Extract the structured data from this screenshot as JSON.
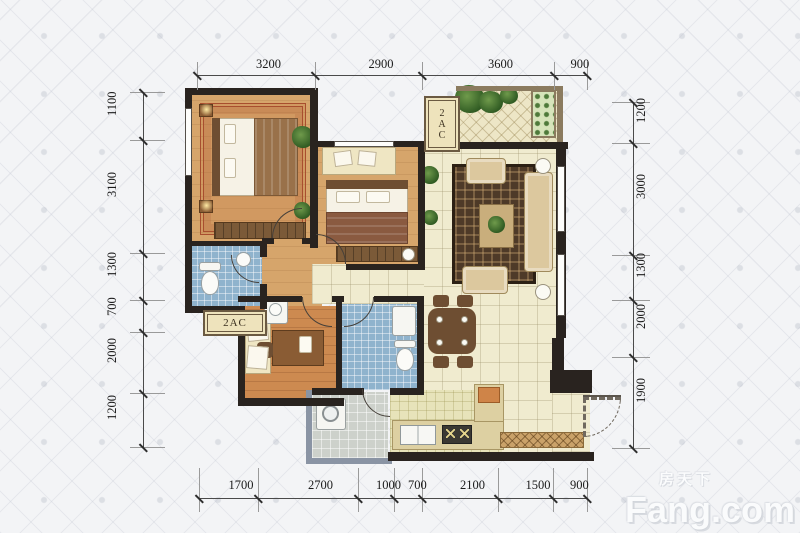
{
  "page": {
    "type": "apartment-floor-plan"
  },
  "dimensions": {
    "top": [
      "3200",
      "2900",
      "3600",
      "900"
    ],
    "bottom": [
      "1700",
      "2700",
      "1000",
      "700",
      "2100",
      "1500",
      "900"
    ],
    "left": [
      "1100",
      "3100",
      "1300",
      "700",
      "2000",
      "1200"
    ],
    "right": [
      "1200",
      "3000",
      "1300",
      "2000",
      "1900"
    ]
  },
  "labels": {
    "ac_platform_top": "2AC",
    "ac_platform_left": "2AC"
  },
  "watermark": {
    "brand_cn": "房天下",
    "brand_en": "Fang.com"
  },
  "palette": {
    "wall": "#29231f",
    "floor_tan": "#d6a56b",
    "floor_wood": "#cd8a50",
    "floor_cream": "#f0ebcf",
    "floor_tile_blue": "#8fb3cd",
    "floor_gray": "#cdd1cb",
    "floor_khaki": "#e7e3ba",
    "rug_red_border": "#a84e2e",
    "rug_dark": "#4e3a28",
    "rail_brown": "#8b7b5f",
    "rail_slate": "#8a94a4",
    "dim_text": "#1b1b1b",
    "background": "#f3f4f6"
  },
  "icons": {
    "double-bed-icon": "css-rect",
    "pillow-icon": "css-rect",
    "wardrobe-icon": "css-striped-rect",
    "nightstand-lamp-icon": "css-glow-dot",
    "toilet-icon": "css-ellipse",
    "sink-icon": "css-circle",
    "bathtub-shower-icon": "css-rect",
    "sofa-icon": "css-rounded-rect",
    "coffee-table-icon": "css-rect",
    "dining-table-icon": "css-rounded-rect",
    "dining-chair-icon": "css-rect",
    "desk-icon": "css-rect",
    "washing-machine-icon": "css-rect-circle",
    "kitchen-sink-icon": "css-divided-rect",
    "stove-icon": "css-rect-x-burners",
    "plant-icon": "css-radial-blob",
    "planter-box-icon": "css-dotted-rect",
    "shoe-cabinet-icon": "css-crosshatch-rect",
    "door-arc-icon": "css-quarter-circle",
    "window-icon": "css-triple-line"
  }
}
